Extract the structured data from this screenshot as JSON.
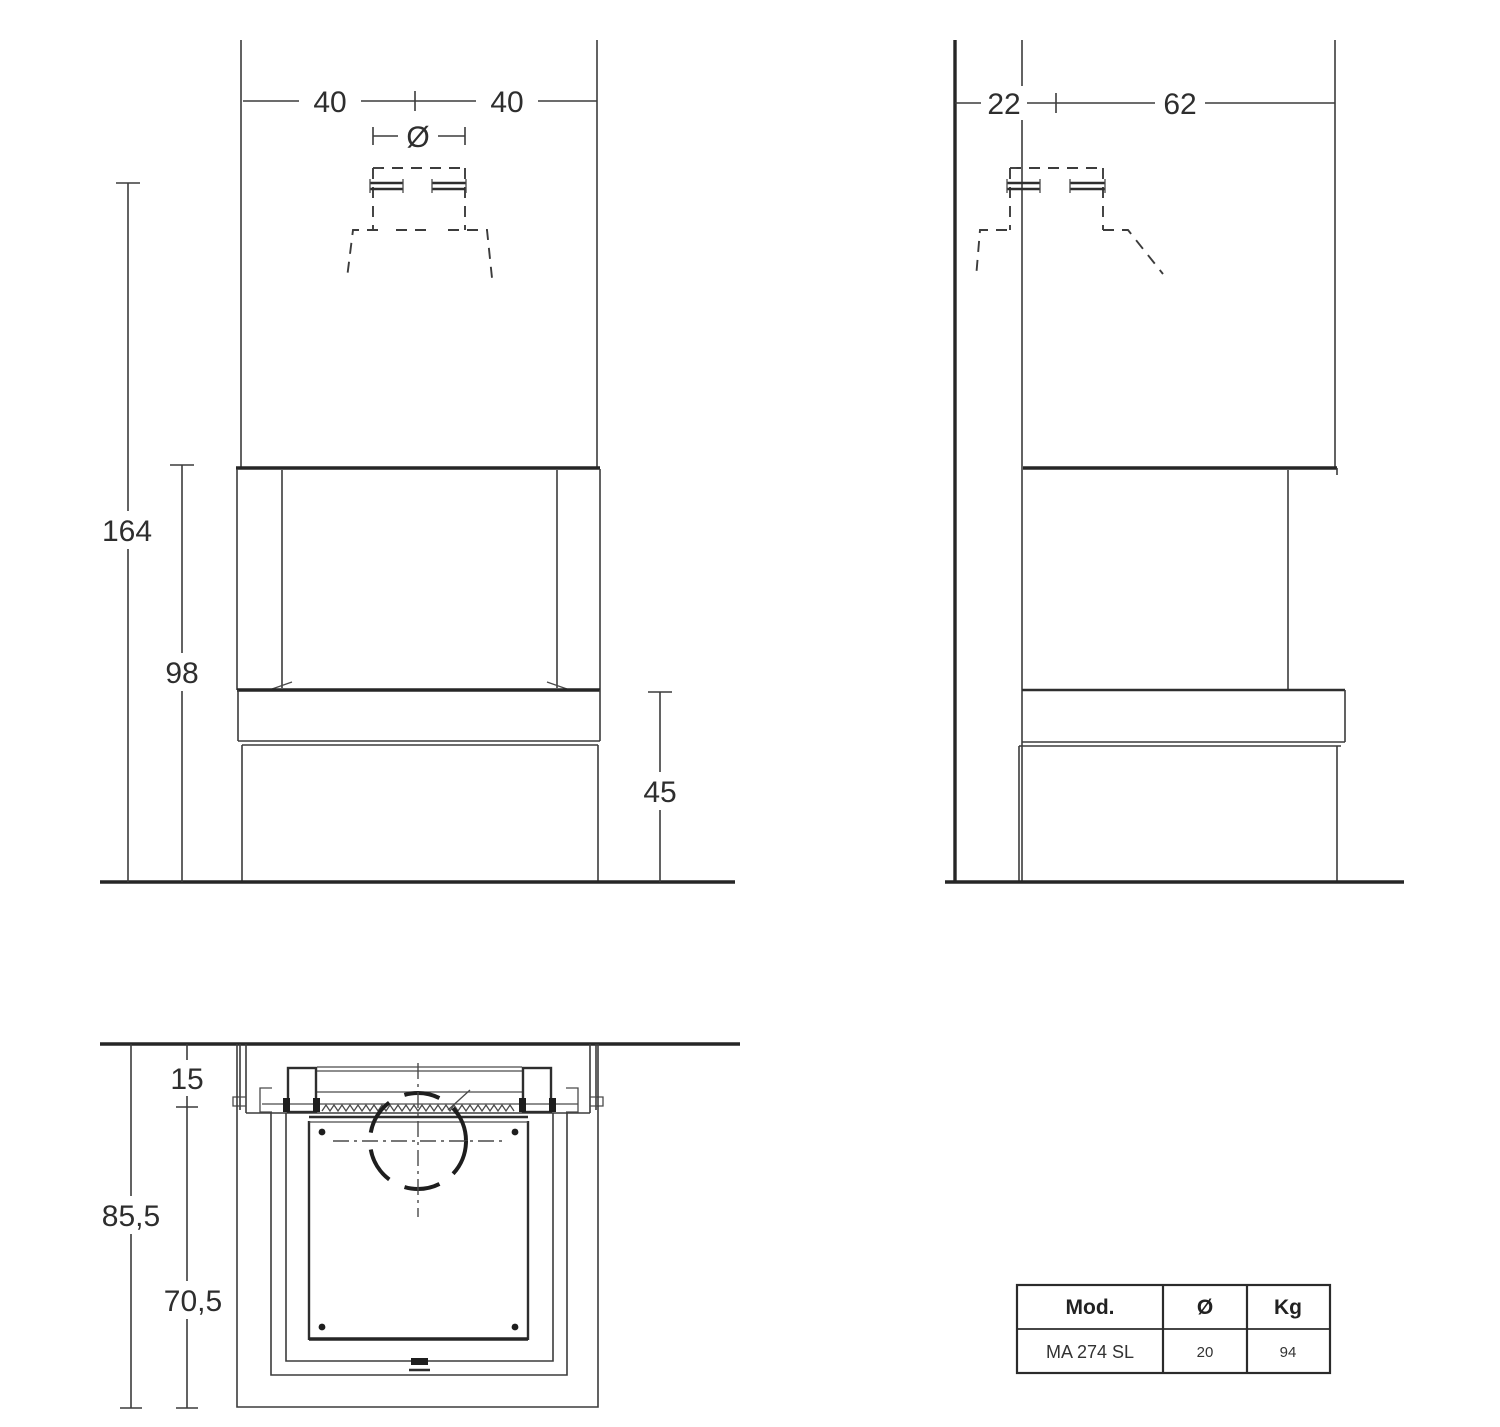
{
  "front_view": {
    "dims": {
      "left_width": "40",
      "right_width": "40",
      "flue_diameter": "Ø",
      "total_height": "164",
      "opening_height": "98",
      "base_height": "45"
    }
  },
  "side_view": {
    "dims": {
      "wall_depth": "22",
      "body_depth": "62"
    }
  },
  "plan_view": {
    "dims": {
      "wall_inset": "15",
      "total_depth": "85,5",
      "body_depth": "70,5"
    }
  },
  "spec_table": {
    "headers": [
      "Mod.",
      "Ø",
      "Kg"
    ],
    "row": [
      "MA 274 SL",
      "20",
      "94"
    ]
  }
}
